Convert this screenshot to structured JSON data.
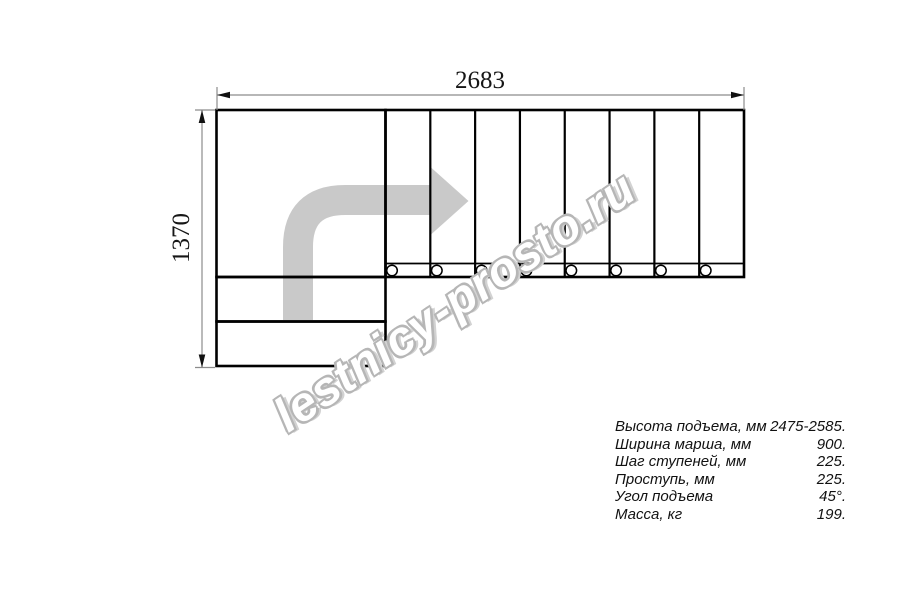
{
  "diagram": {
    "type": "staircase_plan_top_view",
    "width_dimension_label": "2683",
    "height_dimension_label": "1370",
    "upper_flight_step_count": 8,
    "lower_step_count": 2,
    "direction_arrow": "turn-right-then-straight",
    "colors": {
      "outline": "#000000",
      "dimension_line": "#8c8c8c",
      "dimension_arrow": "#111111",
      "direction_arrow": "#c9c9c9",
      "watermark_outline": "#b6b6b6"
    }
  },
  "watermark": {
    "text": "lestnicy-prosto.ru"
  },
  "specs": {
    "rows": [
      {
        "label": "Высота подъема, мм",
        "value": "2475-2585."
      },
      {
        "label": "Ширина марша, мм",
        "value": "900."
      },
      {
        "label": "Шаг ступеней, мм",
        "value": "225."
      },
      {
        "label": "Проступь, мм",
        "value": "225."
      },
      {
        "label": "Угол подъема",
        "value": "45°."
      },
      {
        "label": "Масса, кг",
        "value": "199."
      }
    ]
  }
}
